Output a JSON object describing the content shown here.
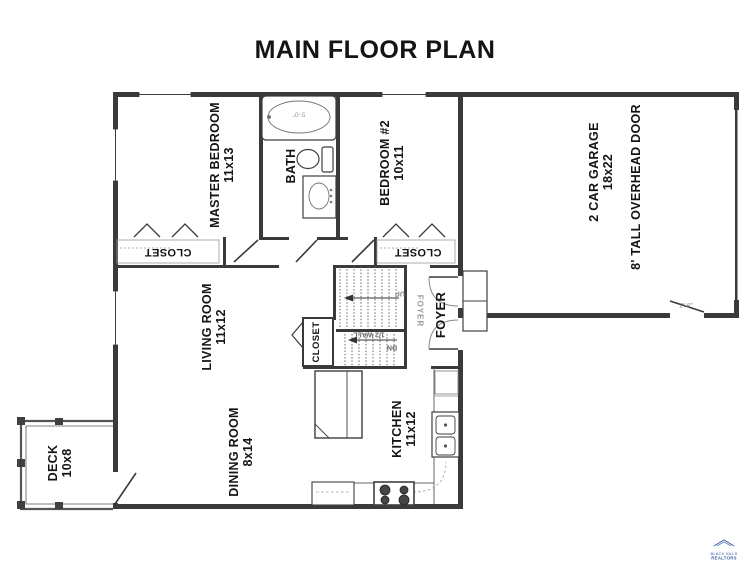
{
  "title": "MAIN FLOOR PLAN",
  "rooms": {
    "master_bedroom": {
      "name": "MASTER BEDROOM",
      "dims": "11x13"
    },
    "bath": {
      "name": "BATH"
    },
    "bedroom_2": {
      "name": "BEDROOM #2",
      "dims": "10x11"
    },
    "living_room": {
      "name": "LIVING ROOM",
      "dims": "11x12"
    },
    "dining_room": {
      "name": "DINING ROOM",
      "dims": "8x14"
    },
    "kitchen": {
      "name": "KITCHEN",
      "dims": "11x12"
    },
    "foyer": {
      "name": "FOYER"
    },
    "deck": {
      "name": "DECK",
      "dims": "10x8"
    },
    "garage": {
      "name": "2 CAR GARAGE",
      "dims": "18x22",
      "door_note": "8' TALL OVERHEAD DOOR"
    },
    "master_closet": {
      "name": "CLOSET"
    },
    "bedroom_2_closet": {
      "name": "CLOSET"
    },
    "stair_closet": {
      "name": "CLOSET"
    }
  },
  "annotations": {
    "half_wall": "1/2 WALL",
    "down": "DN",
    "up": "UP",
    "tub_width": "5'-0\"",
    "garage_door_width": "2'-8\"",
    "foyer_ghost": "FOYER"
  },
  "logo": {
    "line1": "BLACK HILLS",
    "line2": "REALTORS"
  },
  "colors": {
    "wall": "#3a3a3a",
    "fixture_line": "#3f3f3f",
    "faint_line": "#777777",
    "label": "#141414",
    "logo_blue": "#3c5ba6",
    "background": "#ffffff"
  }
}
